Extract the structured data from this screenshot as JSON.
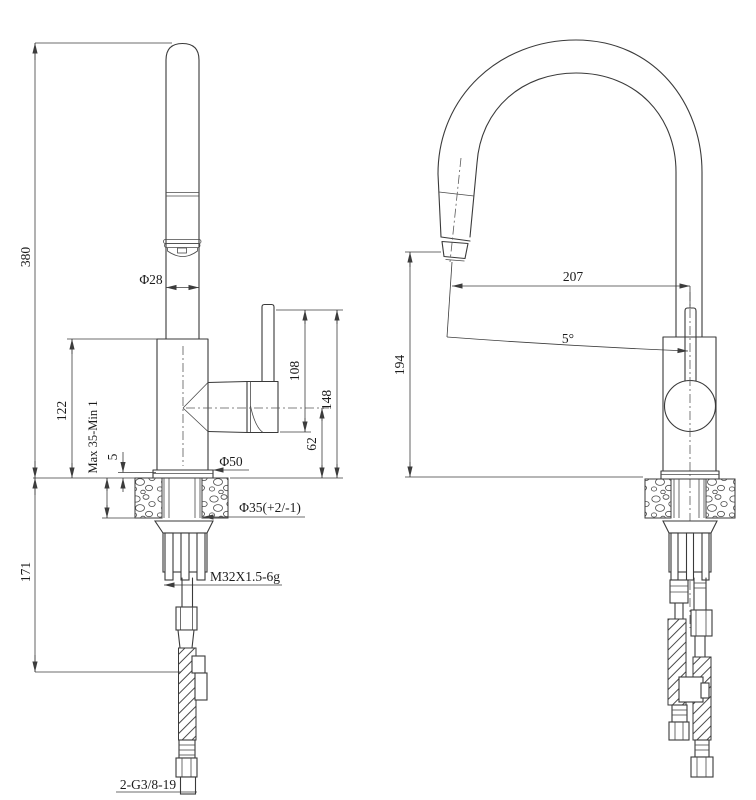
{
  "front_view": {
    "dim_overall_height": "380",
    "dim_spout_diameter": "Φ28",
    "dim_body_height": "122",
    "dim_deck_thickness": "Max 35-Min 1",
    "dim_base_lip": "5",
    "dim_base_diameter": "Φ50",
    "dim_hole_diameter": "Φ35(+2/-1)",
    "dim_shank_thread": "M32X1.5-6g",
    "dim_under_counter": "171",
    "dim_hose_thread": "2-G3/8-19",
    "dim_handle_lever_height": "108",
    "dim_lever_top_height": "148",
    "dim_outlet_center_height": "62"
  },
  "side_view": {
    "dim_reach": "207",
    "dim_head_angle": "5°",
    "dim_outlet_height": "194"
  }
}
